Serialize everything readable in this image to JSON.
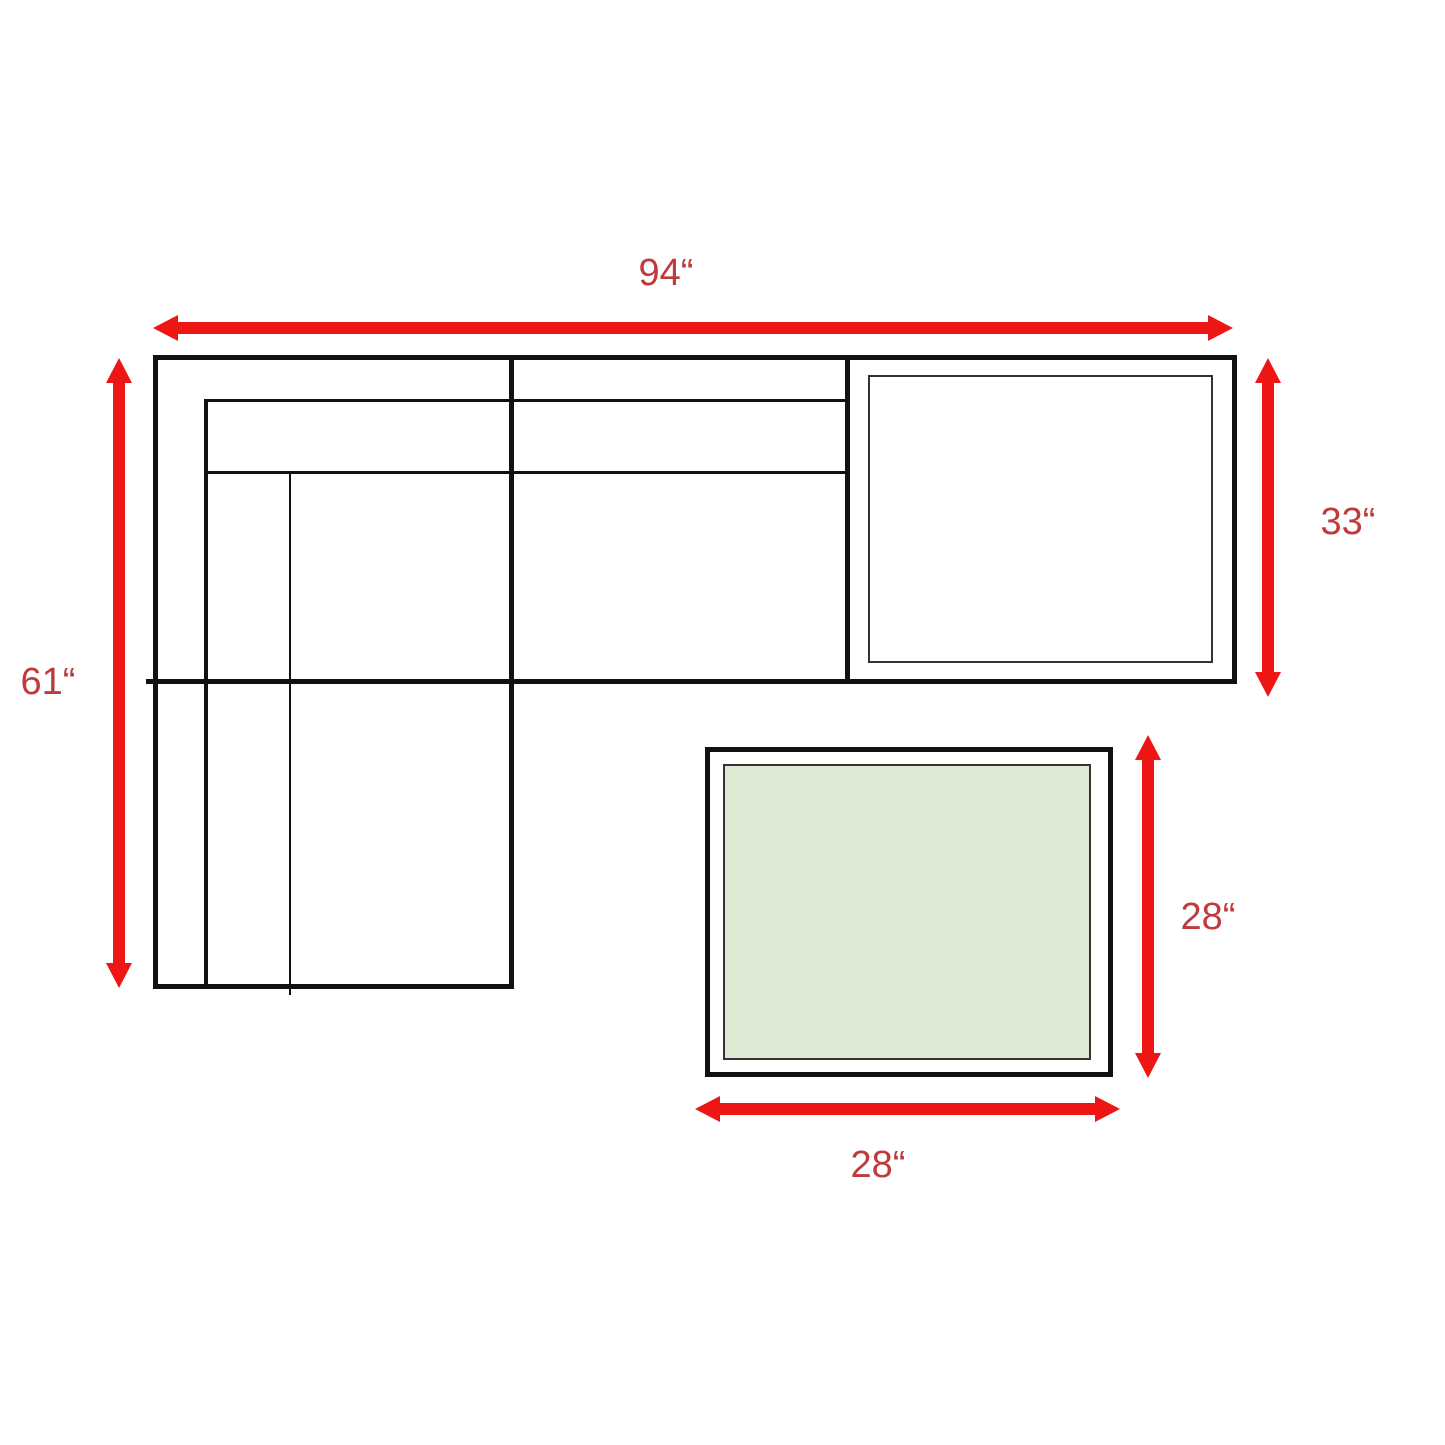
{
  "colors": {
    "arrow": "#ee1515",
    "label": "#c0393b",
    "line": "#111111",
    "lineSoft": "#333333",
    "tableFill": "#dcead3",
    "background": "#ffffff"
  },
  "labels": {
    "sofa_width": "94“",
    "sofa_depth": "61“",
    "corner_depth": "33“",
    "table_depth": "28“",
    "table_width": "28“"
  }
}
